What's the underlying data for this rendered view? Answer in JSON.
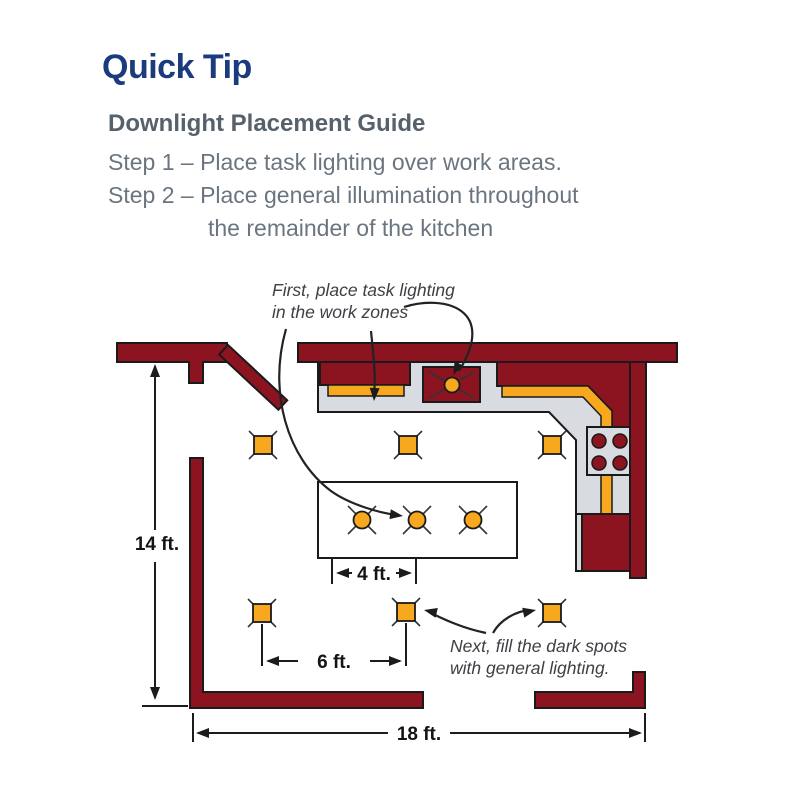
{
  "header": {
    "title": "Quick Tip",
    "guide_title": "Downlight Placement Guide",
    "step1": "Step 1 – Place task lighting over work areas.",
    "step2_line1": "Step 2 – Place general illumination throughout",
    "step2_line2": "the remainder of the kitchen"
  },
  "diagram": {
    "annotations": {
      "task_note_line1": "First, place task lighting",
      "task_note_line2": "in the work zones",
      "general_note_line1": "Next, fill the dark spots",
      "general_note_line2": "with general lighting."
    },
    "dimensions": {
      "room_depth": "14 ft.",
      "island_light_spacing": "4 ft.",
      "general_light_spacing": "6 ft.",
      "room_width": "18 ft."
    },
    "legend": {
      "task_lights": "orange circles and strips over work zones (sink, counters, island)",
      "general_lights": "orange squares spaced through remainder of kitchen"
    }
  },
  "colors": {
    "title_navy": "#1B3B7E",
    "heading_gray": "#57616B",
    "body_gray": "#6B7580",
    "annotation_gray": "#3D4044",
    "wall_maroon": "#8B1420",
    "light_orange": "#F7A81E",
    "counter_gray": "#D8DCE0",
    "outline_black": "#1A1A1A"
  }
}
